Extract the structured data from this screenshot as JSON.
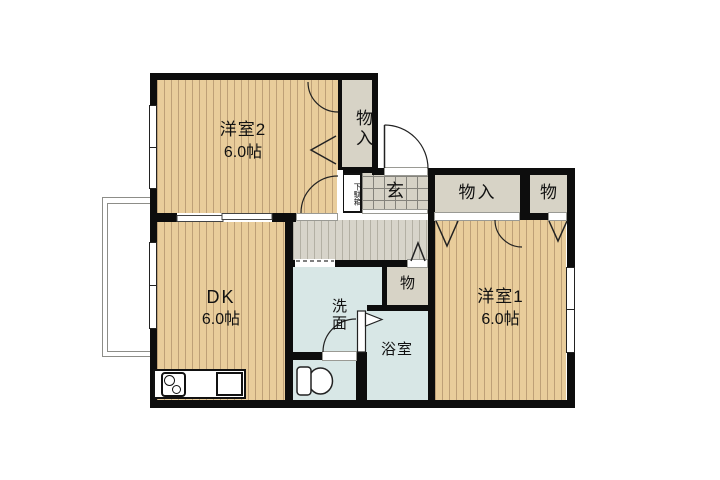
{
  "floorplan": {
    "rooms": {
      "western2": {
        "label": "洋室2",
        "size": "6.0帖"
      },
      "dk": {
        "label": "DK",
        "size": "6.0帖"
      },
      "western1": {
        "label": "洋室1",
        "size": "6.0帖"
      },
      "washroom": {
        "label": "洗面"
      },
      "bathroom": {
        "label": "浴室"
      },
      "entrance": {
        "label": "玄"
      },
      "shoe_cabinet": {
        "label": "下駄箱"
      },
      "closet_top": {
        "label": "物入"
      },
      "closet_hall": {
        "label": "物入"
      },
      "storage_hall": {
        "label": "物"
      },
      "storage_center": {
        "label": "物"
      }
    },
    "colors": {
      "wood": "#e9cd9b",
      "woodStripe": "#bea077",
      "closet": "#d7d3c6",
      "water": "#d8e7e6",
      "hall": "#d7d4ca",
      "hallStripe": "#b3b0a4",
      "tile": "#d6d2c6",
      "tileLine": "#85837c",
      "wall": "#0d0d0d"
    }
  }
}
